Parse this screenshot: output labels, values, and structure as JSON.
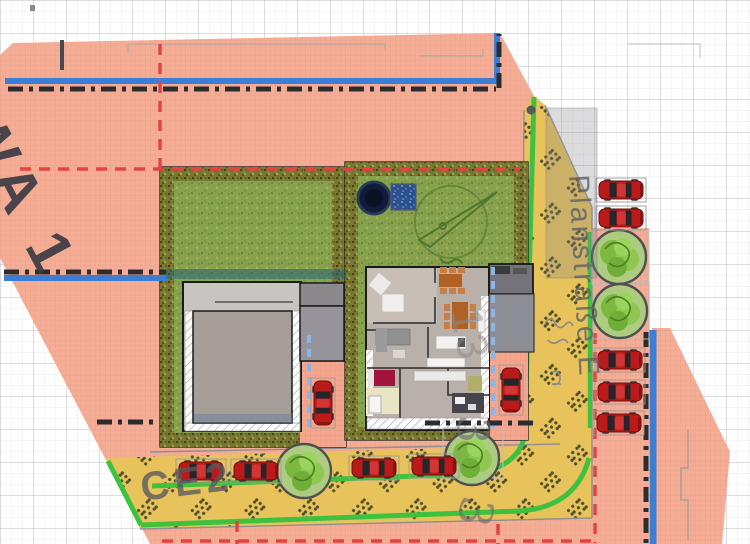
{
  "labels": {
    "zone": "WA 1",
    "street": "Planstraße E",
    "area": "CE2",
    "house_number": "13",
    "lot_number_upper": "3",
    "lot_number_lower": "3"
  },
  "colors": {
    "zone_fill_pink": "#f4a78e",
    "road_yellow": "#e8c35c",
    "road_hatch_dots": "#50502a",
    "lawn_green": "#87a14c",
    "hedge_olive": "#77772f",
    "sidewalk_green": "#3ec13e",
    "boundary_blue": "#3b7ed3",
    "boundary_black_dashdot": "#2c2c2e",
    "red_dashed_line": "#e34343",
    "light_blue_dashed": "#8ab5e8",
    "car_red": "#bb1a1a",
    "building_gray": "#a59d98"
  },
  "objects": {
    "parked_cars_street_right": 5,
    "parked_cars_street_bottom": 4,
    "cars_on_driveways": 2,
    "trees_street_right": 2,
    "trees_street_bottom": 2,
    "ponds": 1,
    "pools": 1
  }
}
